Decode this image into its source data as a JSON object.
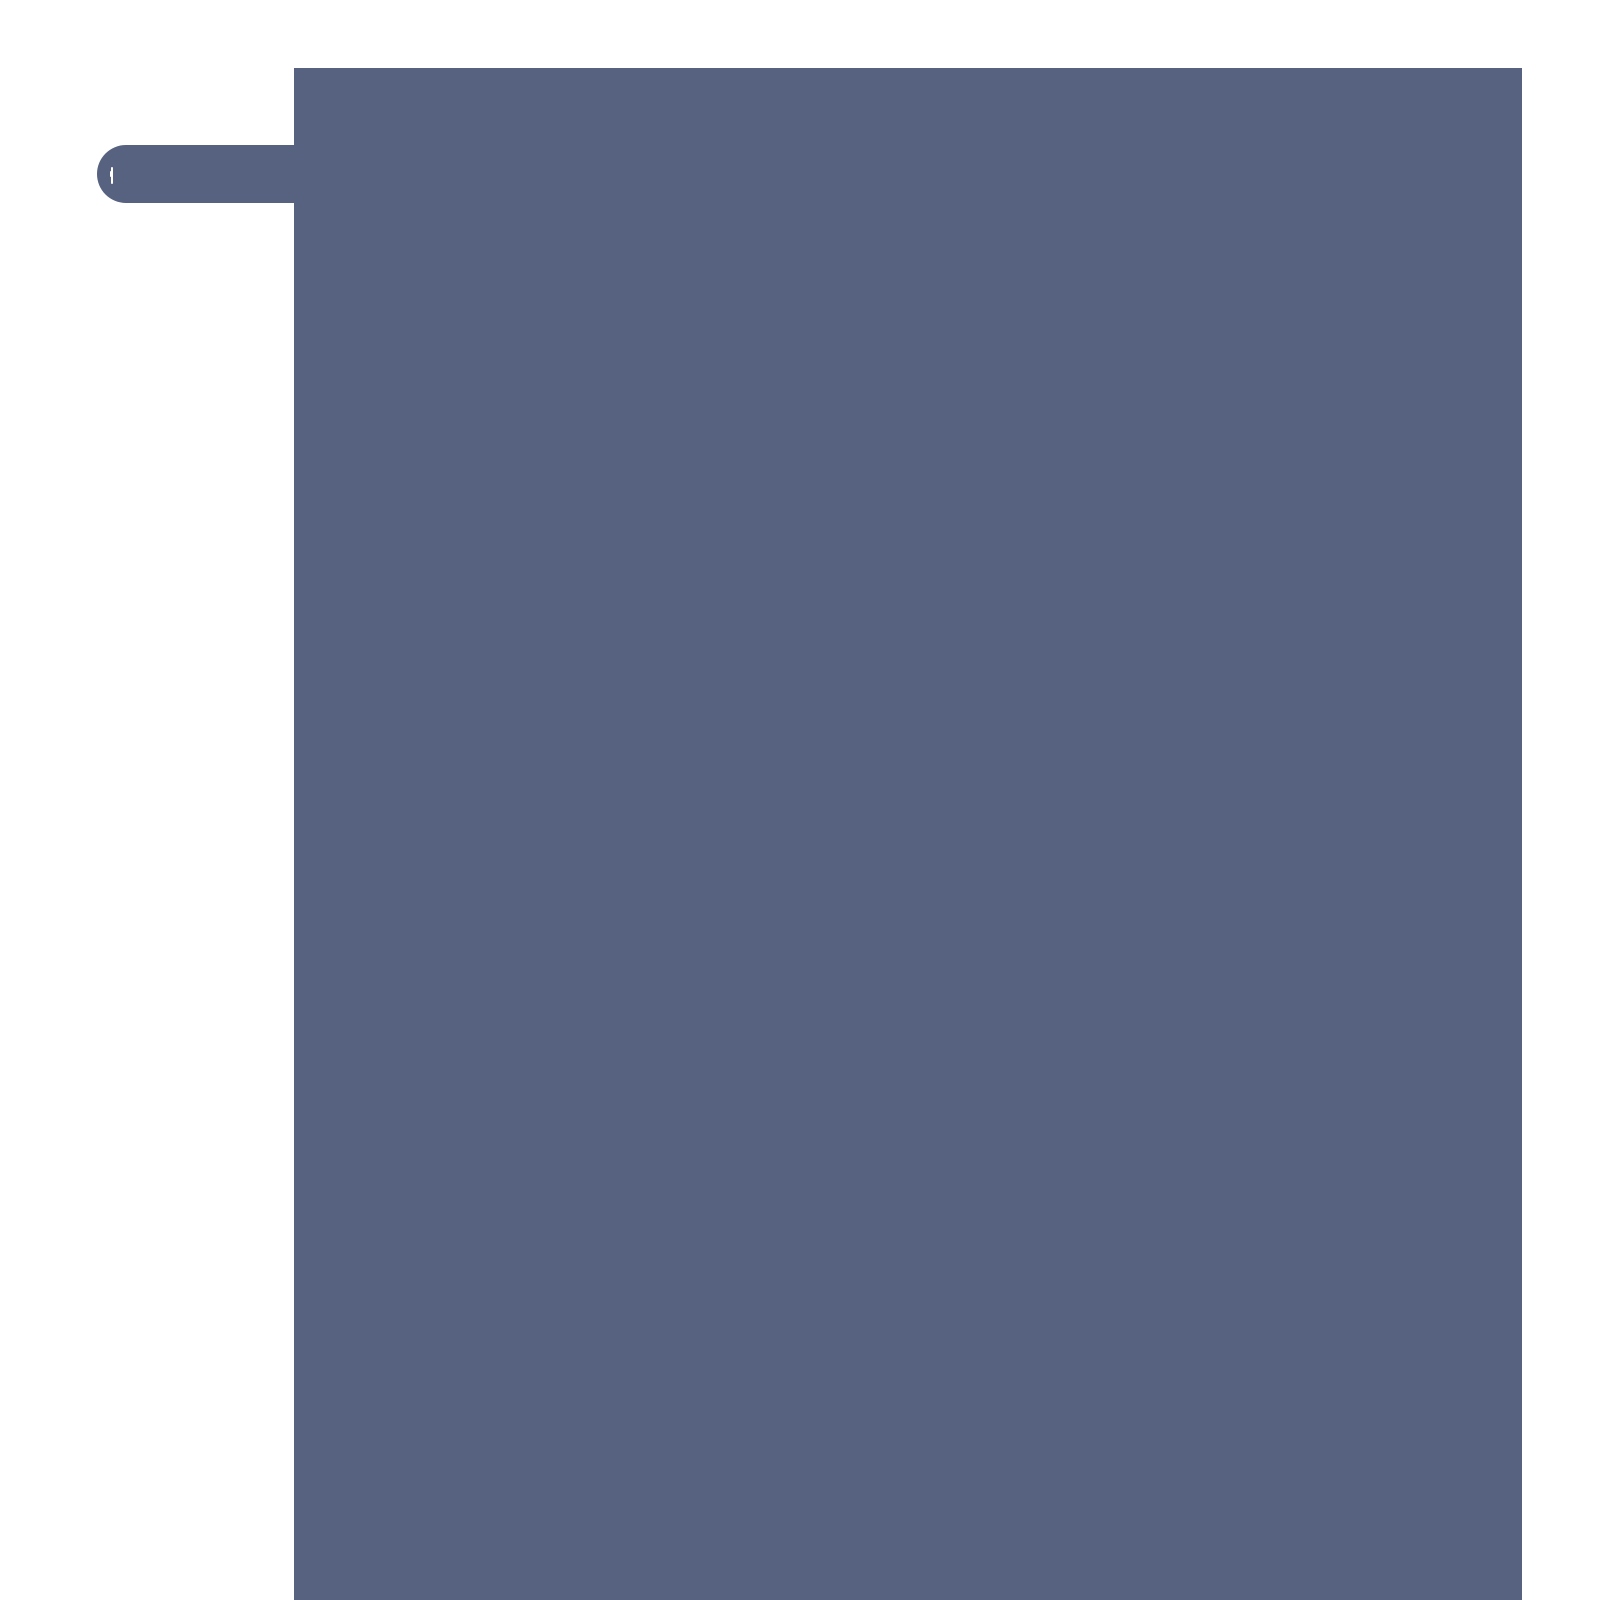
{
  "colors": {
    "background": "#ffffff",
    "panel": "#566280",
    "notch": "#ffffff"
  },
  "icons": {
    "handle": "drawer-pull-handle-icon",
    "notch": "handle-notch-highlight"
  }
}
